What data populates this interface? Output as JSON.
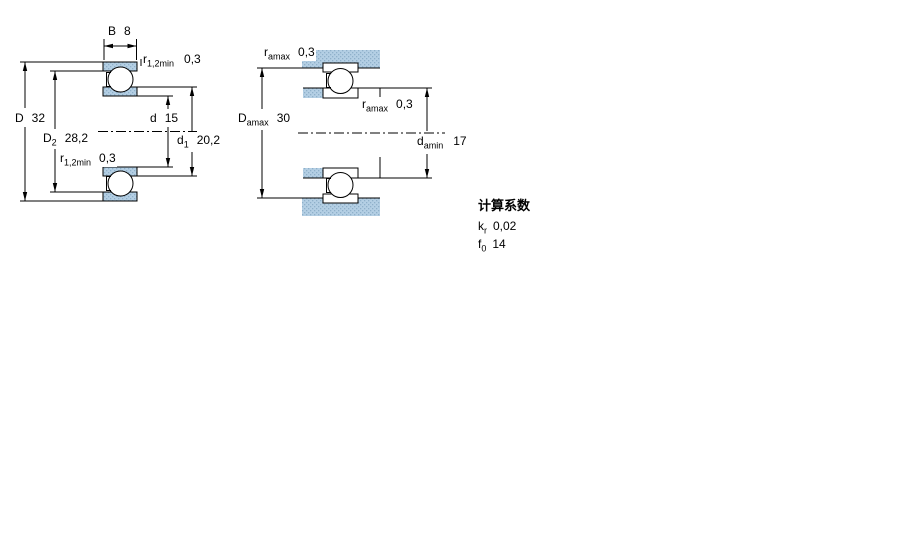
{
  "page": {
    "background": "#ffffff",
    "type": "bearing technical drawing"
  },
  "colors": {
    "material_fill": "#b4cfe4",
    "material_dot": "#8fb0ca",
    "line": "#000000"
  },
  "diagram1": {
    "name": "bearing cross-section with dimensions",
    "labels": {
      "width": {
        "sym": "B",
        "sub": "",
        "val": "8"
      },
      "r_top": {
        "sym": "r",
        "sub": "1,2min",
        "val": "0,3"
      },
      "outside_diameter": {
        "sym": "D",
        "sub": "",
        "val": "32"
      },
      "recess_diameter": {
        "sym": "D",
        "sub": "2",
        "val": "28,2"
      },
      "bore_diameter": {
        "sym": "d",
        "sub": "",
        "val": "15"
      },
      "shoulder_diameter": {
        "sym": "d",
        "sub": "1",
        "val": "20,2"
      },
      "r_bottom": {
        "sym": "r",
        "sub": "1,2min",
        "val": "0,3"
      }
    }
  },
  "diagram2": {
    "name": "abutment and fillet dimensions",
    "labels": {
      "fillet_top": {
        "sym": "r",
        "sub": "amax",
        "val": "0,3"
      },
      "housing_shoulder": {
        "sym": "D",
        "sub": "amax",
        "val": "30"
      },
      "fillet_mid": {
        "sym": "r",
        "sub": "amax",
        "val": "0,3"
      },
      "shaft_shoulder": {
        "sym": "d",
        "sub": "amin",
        "val": "17"
      }
    }
  },
  "calculation_factors": {
    "title": "计算系数",
    "rows": [
      {
        "sym": "k",
        "sub": "r",
        "val": "0,02"
      },
      {
        "sym": "f",
        "sub": "0",
        "val": "14"
      }
    ]
  }
}
